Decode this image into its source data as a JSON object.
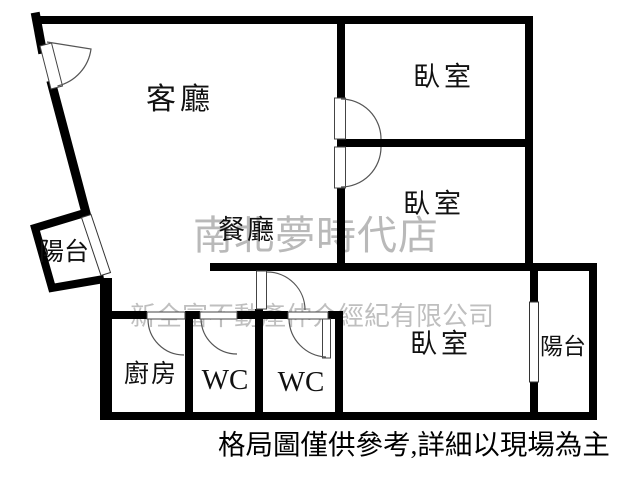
{
  "plan": {
    "rooms": {
      "living": "客廳",
      "dining": "餐廳",
      "bedroom1": "臥室",
      "bedroom2": "臥室",
      "bedroom3": "臥室",
      "kitchen": "廚房",
      "wc1": "WC",
      "wc2": "WC",
      "balcony1": "陽台",
      "balcony2": "陽台"
    },
    "watermark": {
      "line1": "南北夢時代店",
      "line2": "新全富不動產仲介經紀有限公司"
    },
    "note": "格局圖僅供參考,詳細以現場為主",
    "colors": {
      "wall": "#000000",
      "door_line": "#555555",
      "watermark_primary": "#a8a8a8",
      "watermark_secondary": "#b5b5b5",
      "background": "#ffffff",
      "text": "#111111"
    }
  }
}
